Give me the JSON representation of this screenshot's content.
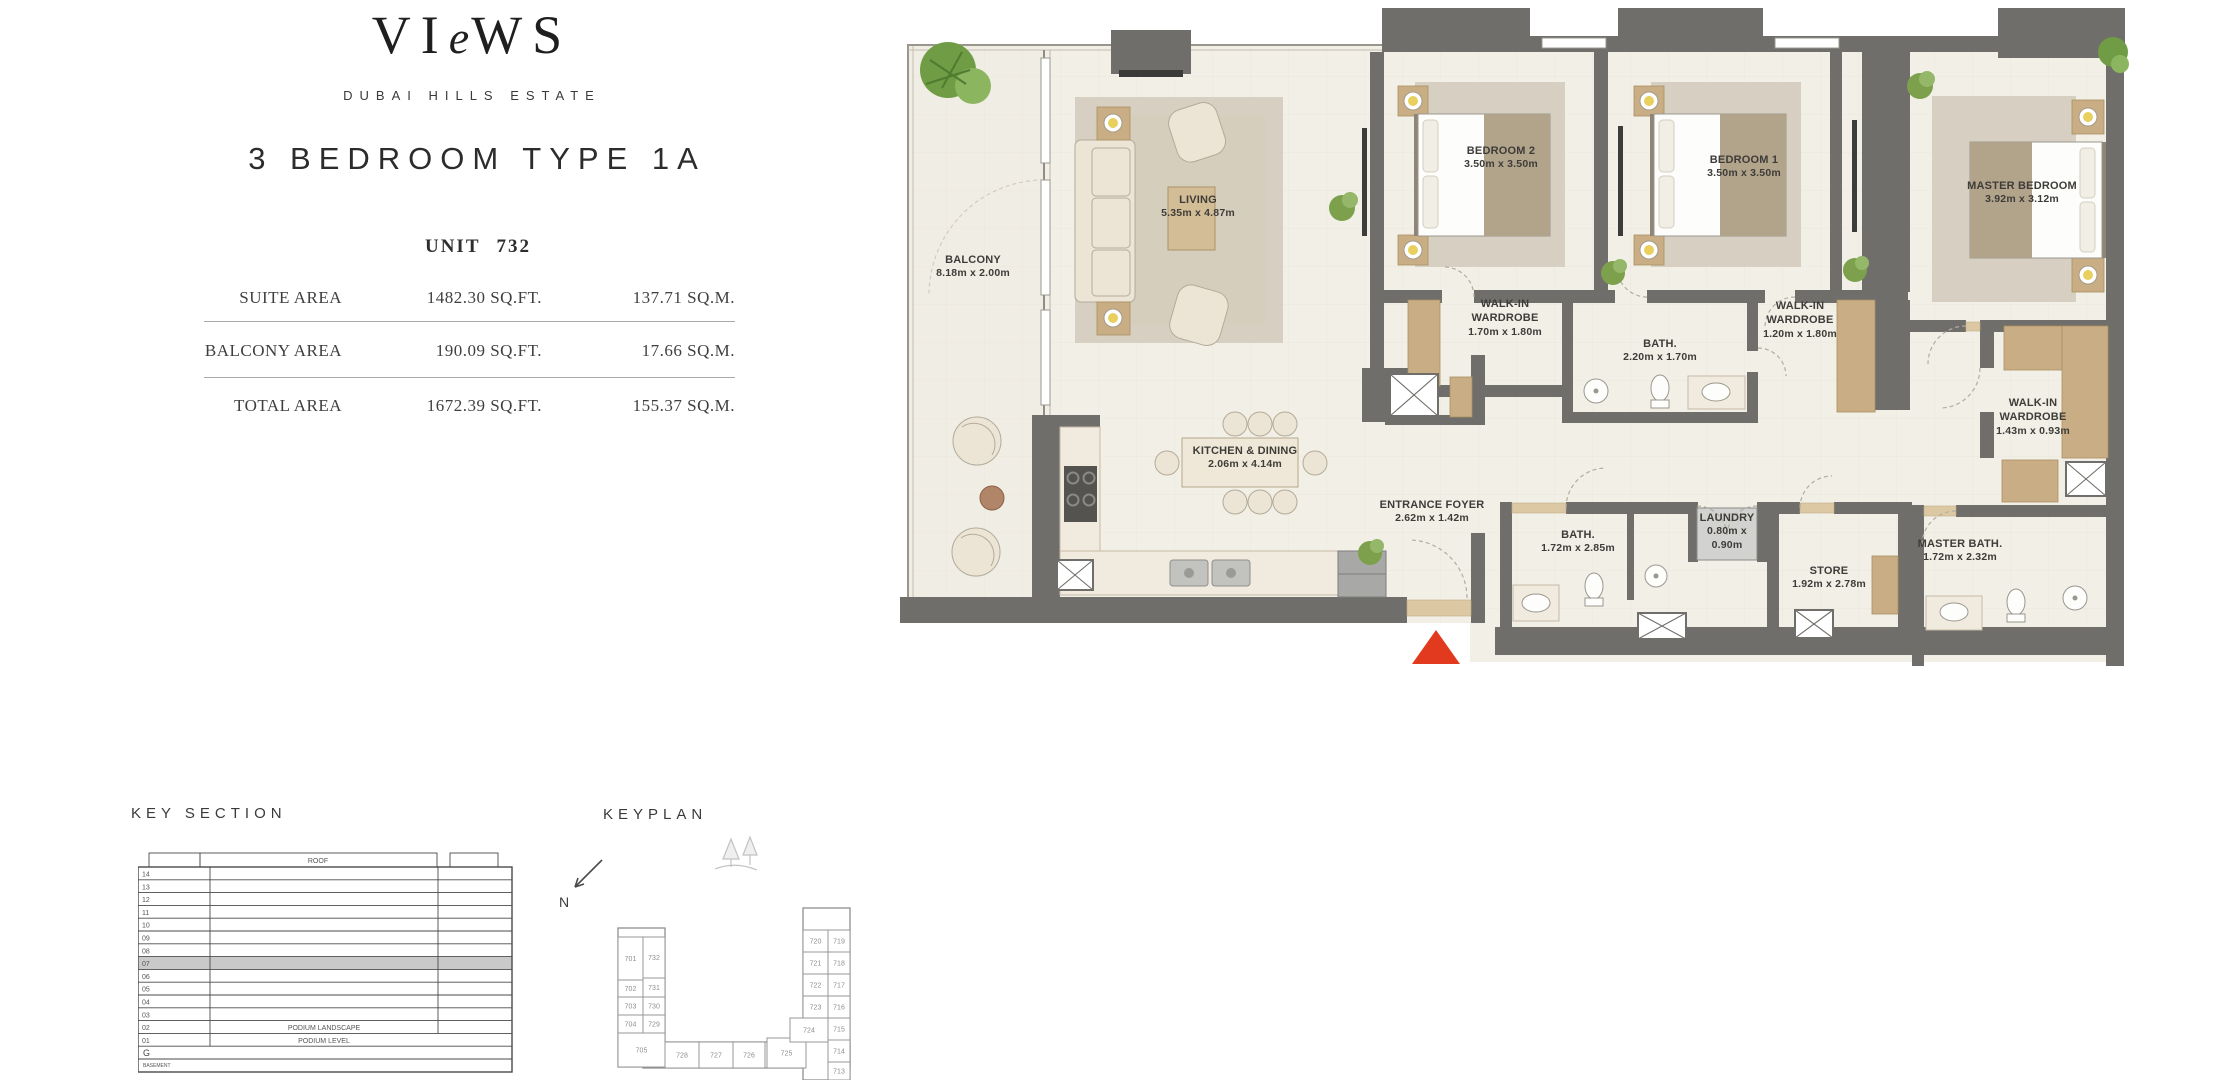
{
  "header": {
    "logo_pre": "VI",
    "logo_e": "e",
    "logo_post": "WS",
    "estate": "DUBAI HILLS ESTATE",
    "title": "3 BEDROOM TYPE 1A",
    "unit_label": "UNIT",
    "unit_number": "732"
  },
  "area_table": {
    "rows": [
      {
        "label": "SUITE AREA",
        "sqft": "1482.30 SQ.FT.",
        "sqm": "137.71 SQ.M."
      },
      {
        "label": "BALCONY AREA",
        "sqft": "190.09 SQ.FT.",
        "sqm": "17.66 SQ.M."
      },
      {
        "label": "TOTAL AREA",
        "sqft": "1672.39 SQ.FT.",
        "sqm": "155.37 SQ.M."
      }
    ]
  },
  "floorplan": {
    "rooms": [
      {
        "name": "BALCONY",
        "dims": "8.18m x 2.00m"
      },
      {
        "name": "LIVING",
        "dims": "5.35m x 4.87m"
      },
      {
        "name": "BEDROOM 2",
        "dims": "3.50m x 3.50m"
      },
      {
        "name": "BEDROOM 1",
        "dims": "3.50m x 3.50m"
      },
      {
        "name": "MASTER BEDROOM",
        "dims": "3.92m x 3.12m"
      },
      {
        "name": "WALK-IN WARDROBE",
        "dims": "1.70m x 1.80m"
      },
      {
        "name": "BATH.",
        "dims": "2.20m x 1.70m"
      },
      {
        "name": "WALK-IN WARDROBE",
        "dims": "1.20m x 1.80m"
      },
      {
        "name": "WALK-IN WARDROBE",
        "dims": "1.43m x 0.93m"
      },
      {
        "name": "KITCHEN & DINING",
        "dims": "2.06m x 4.14m"
      },
      {
        "name": "ENTRANCE FOYER",
        "dims": "2.62m x 1.42m"
      },
      {
        "name": "BATH.",
        "dims": "1.72m x 2.85m"
      },
      {
        "name": "LAUNDRY",
        "dims": "0.80m x 0.90m"
      },
      {
        "name": "STORE",
        "dims": "1.92m x 2.78m"
      },
      {
        "name": "MASTER BATH.",
        "dims": "1.72m x 2.32m"
      }
    ]
  },
  "key_section": {
    "title": "KEY SECTION",
    "roof": "ROOF",
    "floors": [
      "14",
      "13",
      "12",
      "11",
      "10",
      "09",
      "08",
      "07",
      "06",
      "05",
      "04",
      "03",
      "02",
      "01"
    ],
    "highlight": "07",
    "podium_landscape": "PODIUM LANDSCAPE",
    "podium_level": "PODIUM LEVEL",
    "ground": "G",
    "basement": "BASEMENT"
  },
  "keyplan": {
    "title": "KEYPLAN",
    "north": "N",
    "highlight_unit": "732",
    "units": {
      "701": "701",
      "702": "702",
      "703": "703",
      "704": "704",
      "705": "705",
      "713": "713",
      "714": "714",
      "715": "715",
      "716": "716",
      "717": "717",
      "718": "718",
      "719": "719",
      "720": "720",
      "721": "721",
      "722": "722",
      "723": "723",
      "724": "724",
      "725": "725",
      "726": "726",
      "727": "727",
      "728": "728",
      "729": "729",
      "730": "730",
      "731": "731",
      "732": "732"
    }
  },
  "colors": {
    "wall": "#6f6e6a",
    "accent_red": "#e23a1f",
    "wood": "#c9ae85",
    "floor": "#f2efe7",
    "highlight_gray": "#c9c9c9"
  }
}
